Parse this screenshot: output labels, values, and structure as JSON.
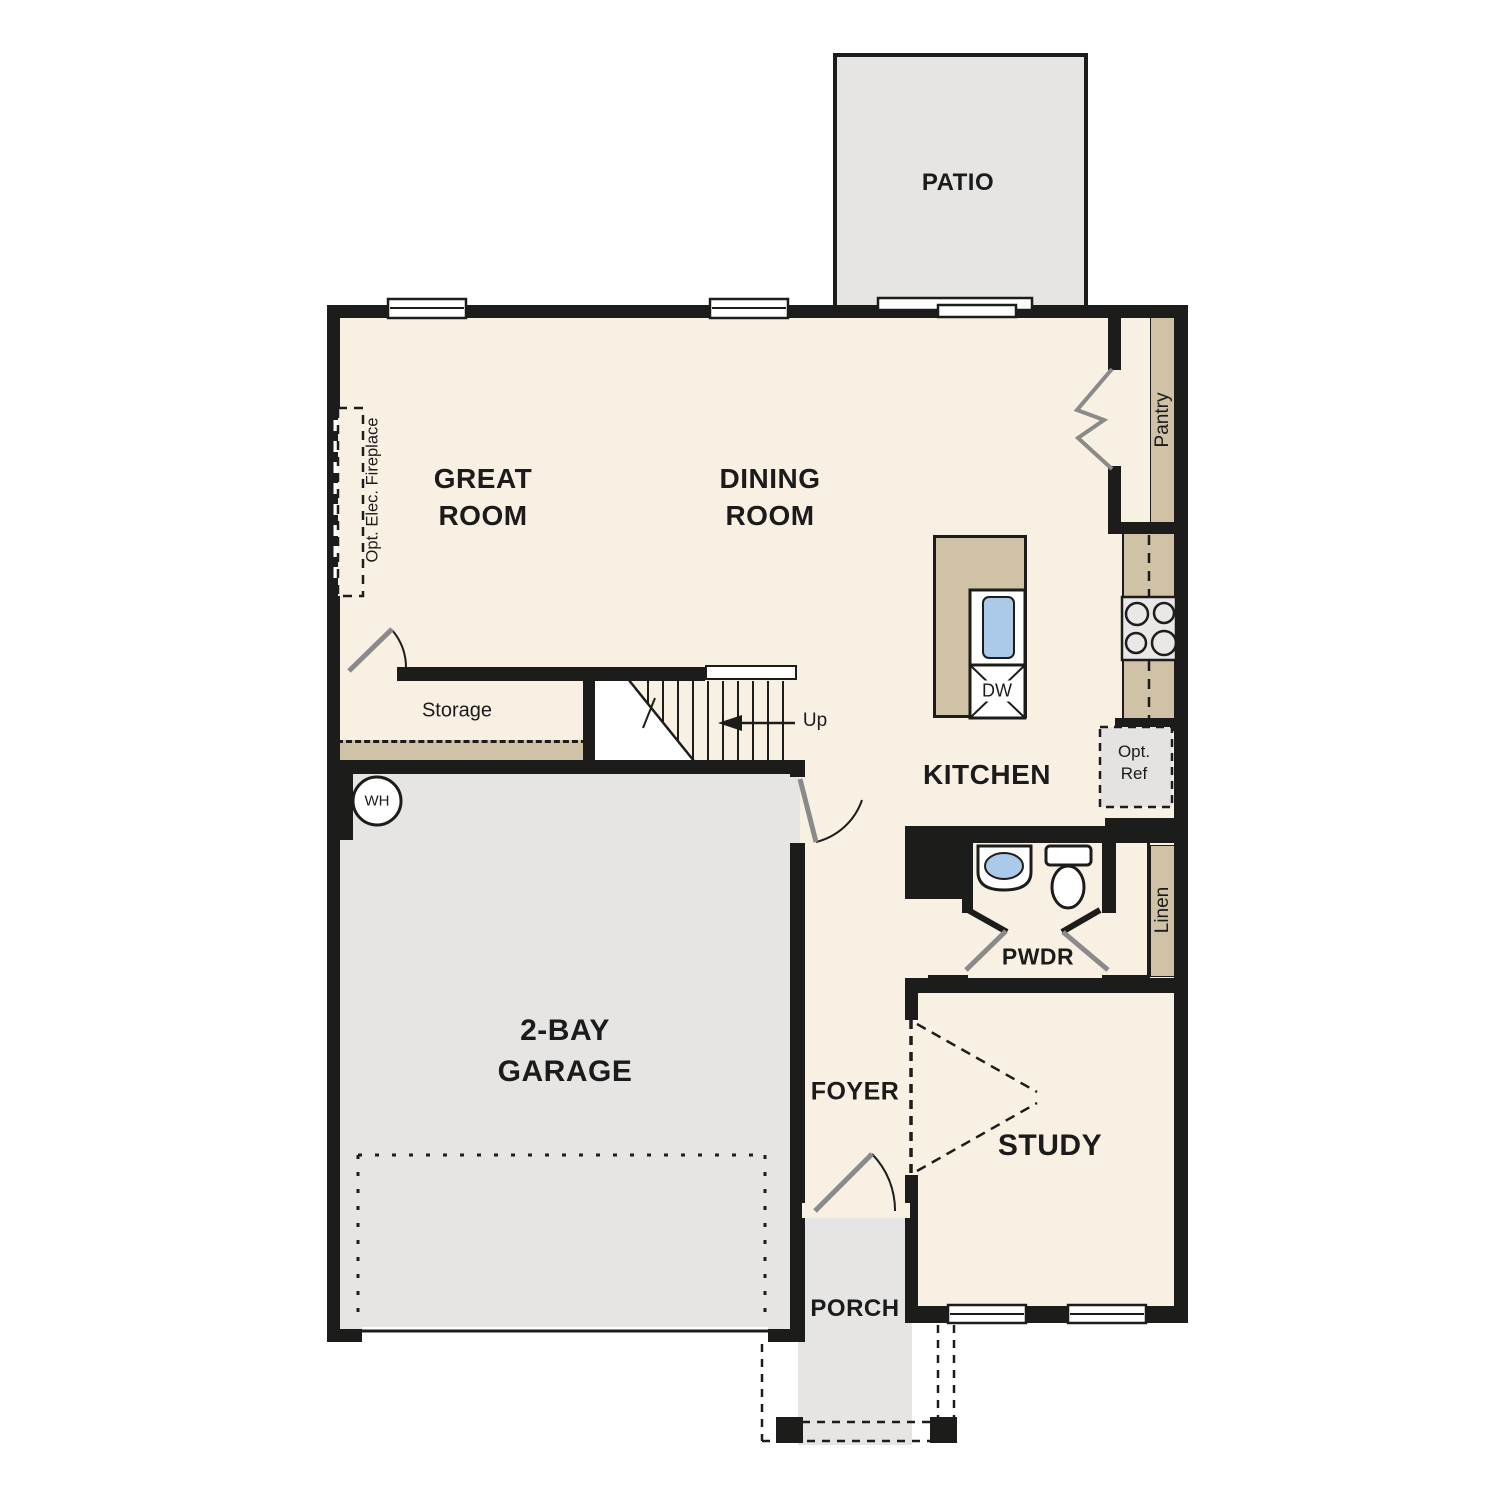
{
  "plan": {
    "title": "First floor residential floor plan",
    "labels": {
      "patio": "PATIO",
      "great_room": "GREAT ROOM",
      "dining_room": "DINING ROOM",
      "kitchen": "KITCHEN",
      "pantry": "Pantry",
      "storage": "Storage",
      "garage": "2-BAY GARAGE",
      "foyer": "FOYER",
      "study": "STUDY",
      "porch": "PORCH",
      "pwdr": "PWDR",
      "linen": "Linen",
      "up": "Up",
      "dw": "DW",
      "wh": "WH",
      "opt_ref": "Opt. Ref",
      "opt_elec_fireplace": "Opt. Elec. Fireplace"
    },
    "fixtures": [
      "kitchen-island-sink",
      "dishwasher",
      "range-stove",
      "optional-refrigerator",
      "water-heater",
      "powder-sink",
      "toilet",
      "stairs-up",
      "optional-electric-fireplace",
      "patio-sliding-door",
      "front-door",
      "garage-entry-door",
      "pantry-bifold-door",
      "study-optional-double-door",
      "garage-overhead-door",
      "porch-posts"
    ],
    "colors": {
      "wall": "#1c1c1a",
      "floor": "#f8f0e3",
      "outdoor": "#e6e5e3",
      "casework": "#cfc2a6",
      "sink-blue": "#abc9e9",
      "ink": "#1b1b1b",
      "leaf": "#8a8a8a"
    }
  }
}
